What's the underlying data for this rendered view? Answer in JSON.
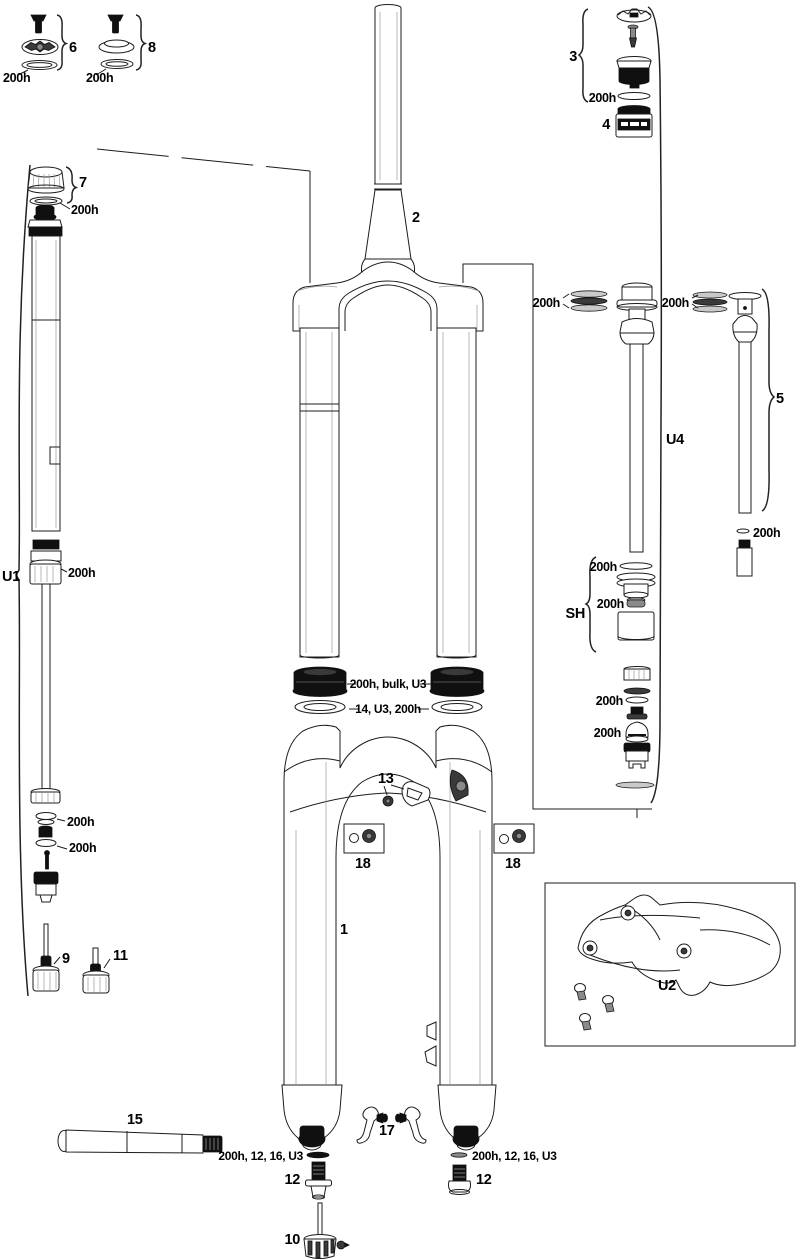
{
  "diagram": {
    "type": "exploded-parts-diagram",
    "subject": "suspension-fork-service-diagram",
    "labels": {
      "n1": "1",
      "n2": "2",
      "n3": "3",
      "n4": "4",
      "n5": "5",
      "n6": "6",
      "n7": "7",
      "n8": "8",
      "n9": "9",
      "n10": "10",
      "n11": "11",
      "n12": "12",
      "n13": "13",
      "n15": "15",
      "n17": "17",
      "n18": "18",
      "u1": "U1",
      "u2": "U2",
      "u4": "U4",
      "sh": "SH",
      "h200": "200h",
      "seal": "200h, bulk, U3",
      "foam": "14, U3, 200h",
      "washer": "200h, 12, 16, U3"
    },
    "colors": {
      "line": "#1c1c1c",
      "dark_part": "#101010",
      "background": "#ffffff"
    }
  }
}
